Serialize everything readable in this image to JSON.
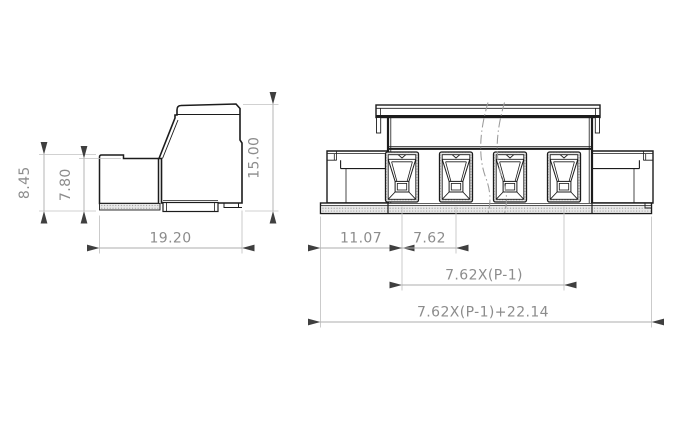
{
  "drawing": {
    "type": "technical-dimension-drawing",
    "subject": "pluggable terminal block connector, side view and front view",
    "side_view": {
      "dim_height_outer": "8.45",
      "dim_height_inner": "7.80",
      "dim_width": "19.20",
      "dim_total_height": "15.00"
    },
    "front_view": {
      "pole_count": 4,
      "dim_edge_to_first_pole": "11.07",
      "dim_pitch": "7.62",
      "dim_pole_span": "7.62X(P-1)",
      "dim_total_width": "7.62X(P-1)+22.14"
    },
    "colors": {
      "outline": "#1c1c1c",
      "dim_text": "#8c8c8c",
      "dim_line": "#adadad",
      "extension_line": "#c2c2c2",
      "arrow": "#3f3f3f",
      "background": "#ffffff"
    }
  }
}
